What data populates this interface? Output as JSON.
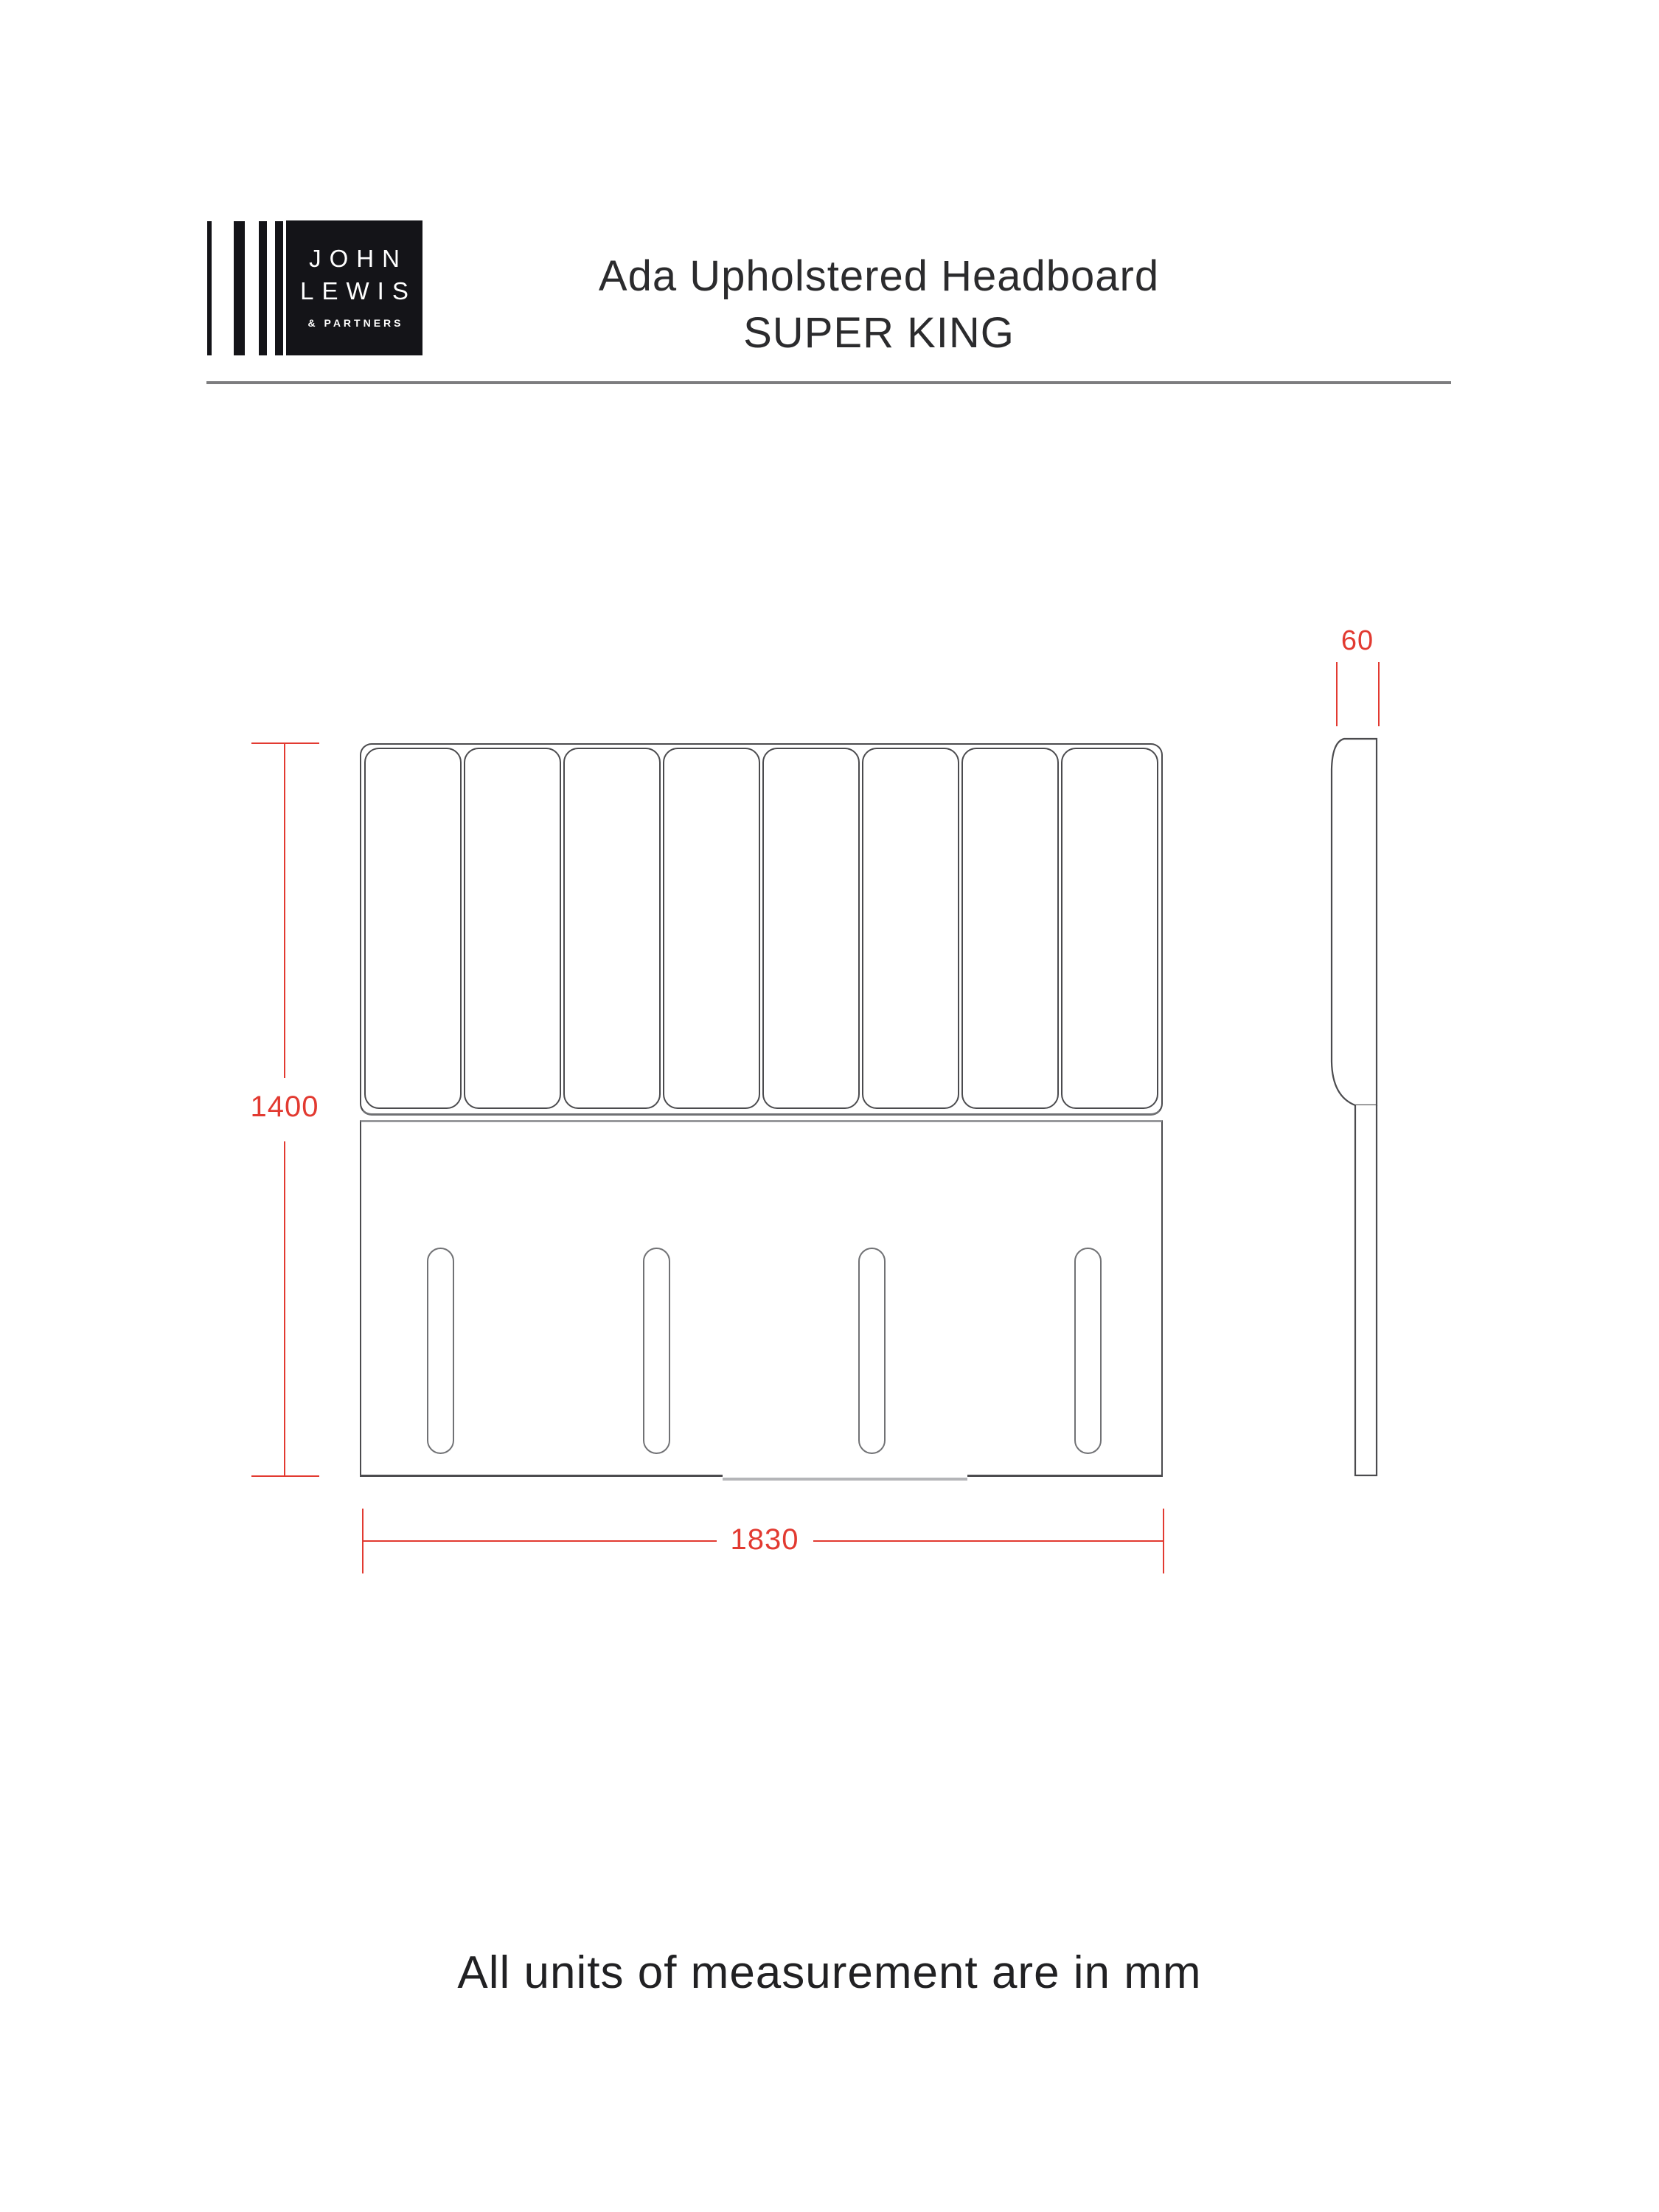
{
  "header": {
    "logo": {
      "line1": "JOHN",
      "line2": "LEWIS",
      "line3": "& PARTNERS"
    },
    "title_line1": "Ada Upholstered Headboard",
    "title_line2": "SUPER KING"
  },
  "diagram": {
    "type": "technical-dimension-drawing",
    "views": {
      "front": {
        "tufted_panel_count": 8,
        "fixing_slot_count": 4
      },
      "side": {
        "shown": true
      }
    },
    "dimensions": {
      "height_mm": "1400",
      "width_mm": "1830",
      "depth_mm": "60"
    },
    "colors": {
      "dimension_red": "#e23a31",
      "line_dark": "#4b4b4e",
      "line_light": "#b4b5b8",
      "logo_black": "#141418"
    }
  },
  "footer": {
    "note": "All units of measurement are in mm"
  }
}
